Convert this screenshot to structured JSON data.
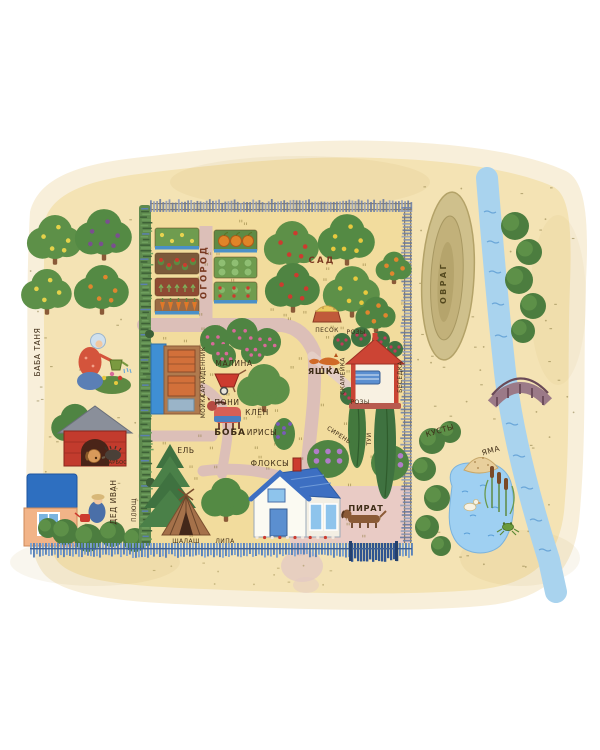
{
  "map": {
    "garden": {
      "ogorod": "ОГОРОД",
      "sad": "САД",
      "pesok": "ПЕСОК",
      "rozy_upper": "РОЗЫ",
      "rozy_lower": "РОЗЫ",
      "skameyka": "СКАМЕЙКА",
      "besedka": "БЕСЕДКА",
      "yashka": "ЯШКА",
      "malina": "МАЛИНА",
      "dennik": "ДЕННИК",
      "saray": "САРАЙ",
      "moyka": "МОЙКА",
      "poni": "ПОНИ",
      "boba": "БОБА",
      "klyon": "КЛЁН",
      "irisy": "ИРИСЫ",
      "siren": "СИРЕНЬ",
      "tui": "ТУИ",
      "yel": "ЕЛЬ",
      "floksy": "ФЛОКСЫ",
      "shalash": "ШАЛАШ",
      "lipa": "ЛИПА",
      "pirat": "ПИРАТ"
    },
    "left_yard": {
      "baba_tanya": "БАБА ТАНЯ",
      "ded_ivan": "ДЕД ИВАН",
      "plyushch": "ПЛЮЩ",
      "barbos": "БАРБОС"
    },
    "right_side": {
      "ovrag": "ОВРАГ",
      "kusty": "КУСТЫ",
      "yama": "ЯМА"
    },
    "colors": {
      "paper": "#f6ead0",
      "garden_ground": "#f2dc9d",
      "path_pink": "#dcbfb8",
      "river_blue": "#a9d3ee",
      "fence_blue": "#5b82b8",
      "ivy_green": "#5e8a4e",
      "gazebo_red": "#c94434",
      "roof_blue": "#3d6fc2",
      "label_ink": "#3f2d17"
    }
  }
}
